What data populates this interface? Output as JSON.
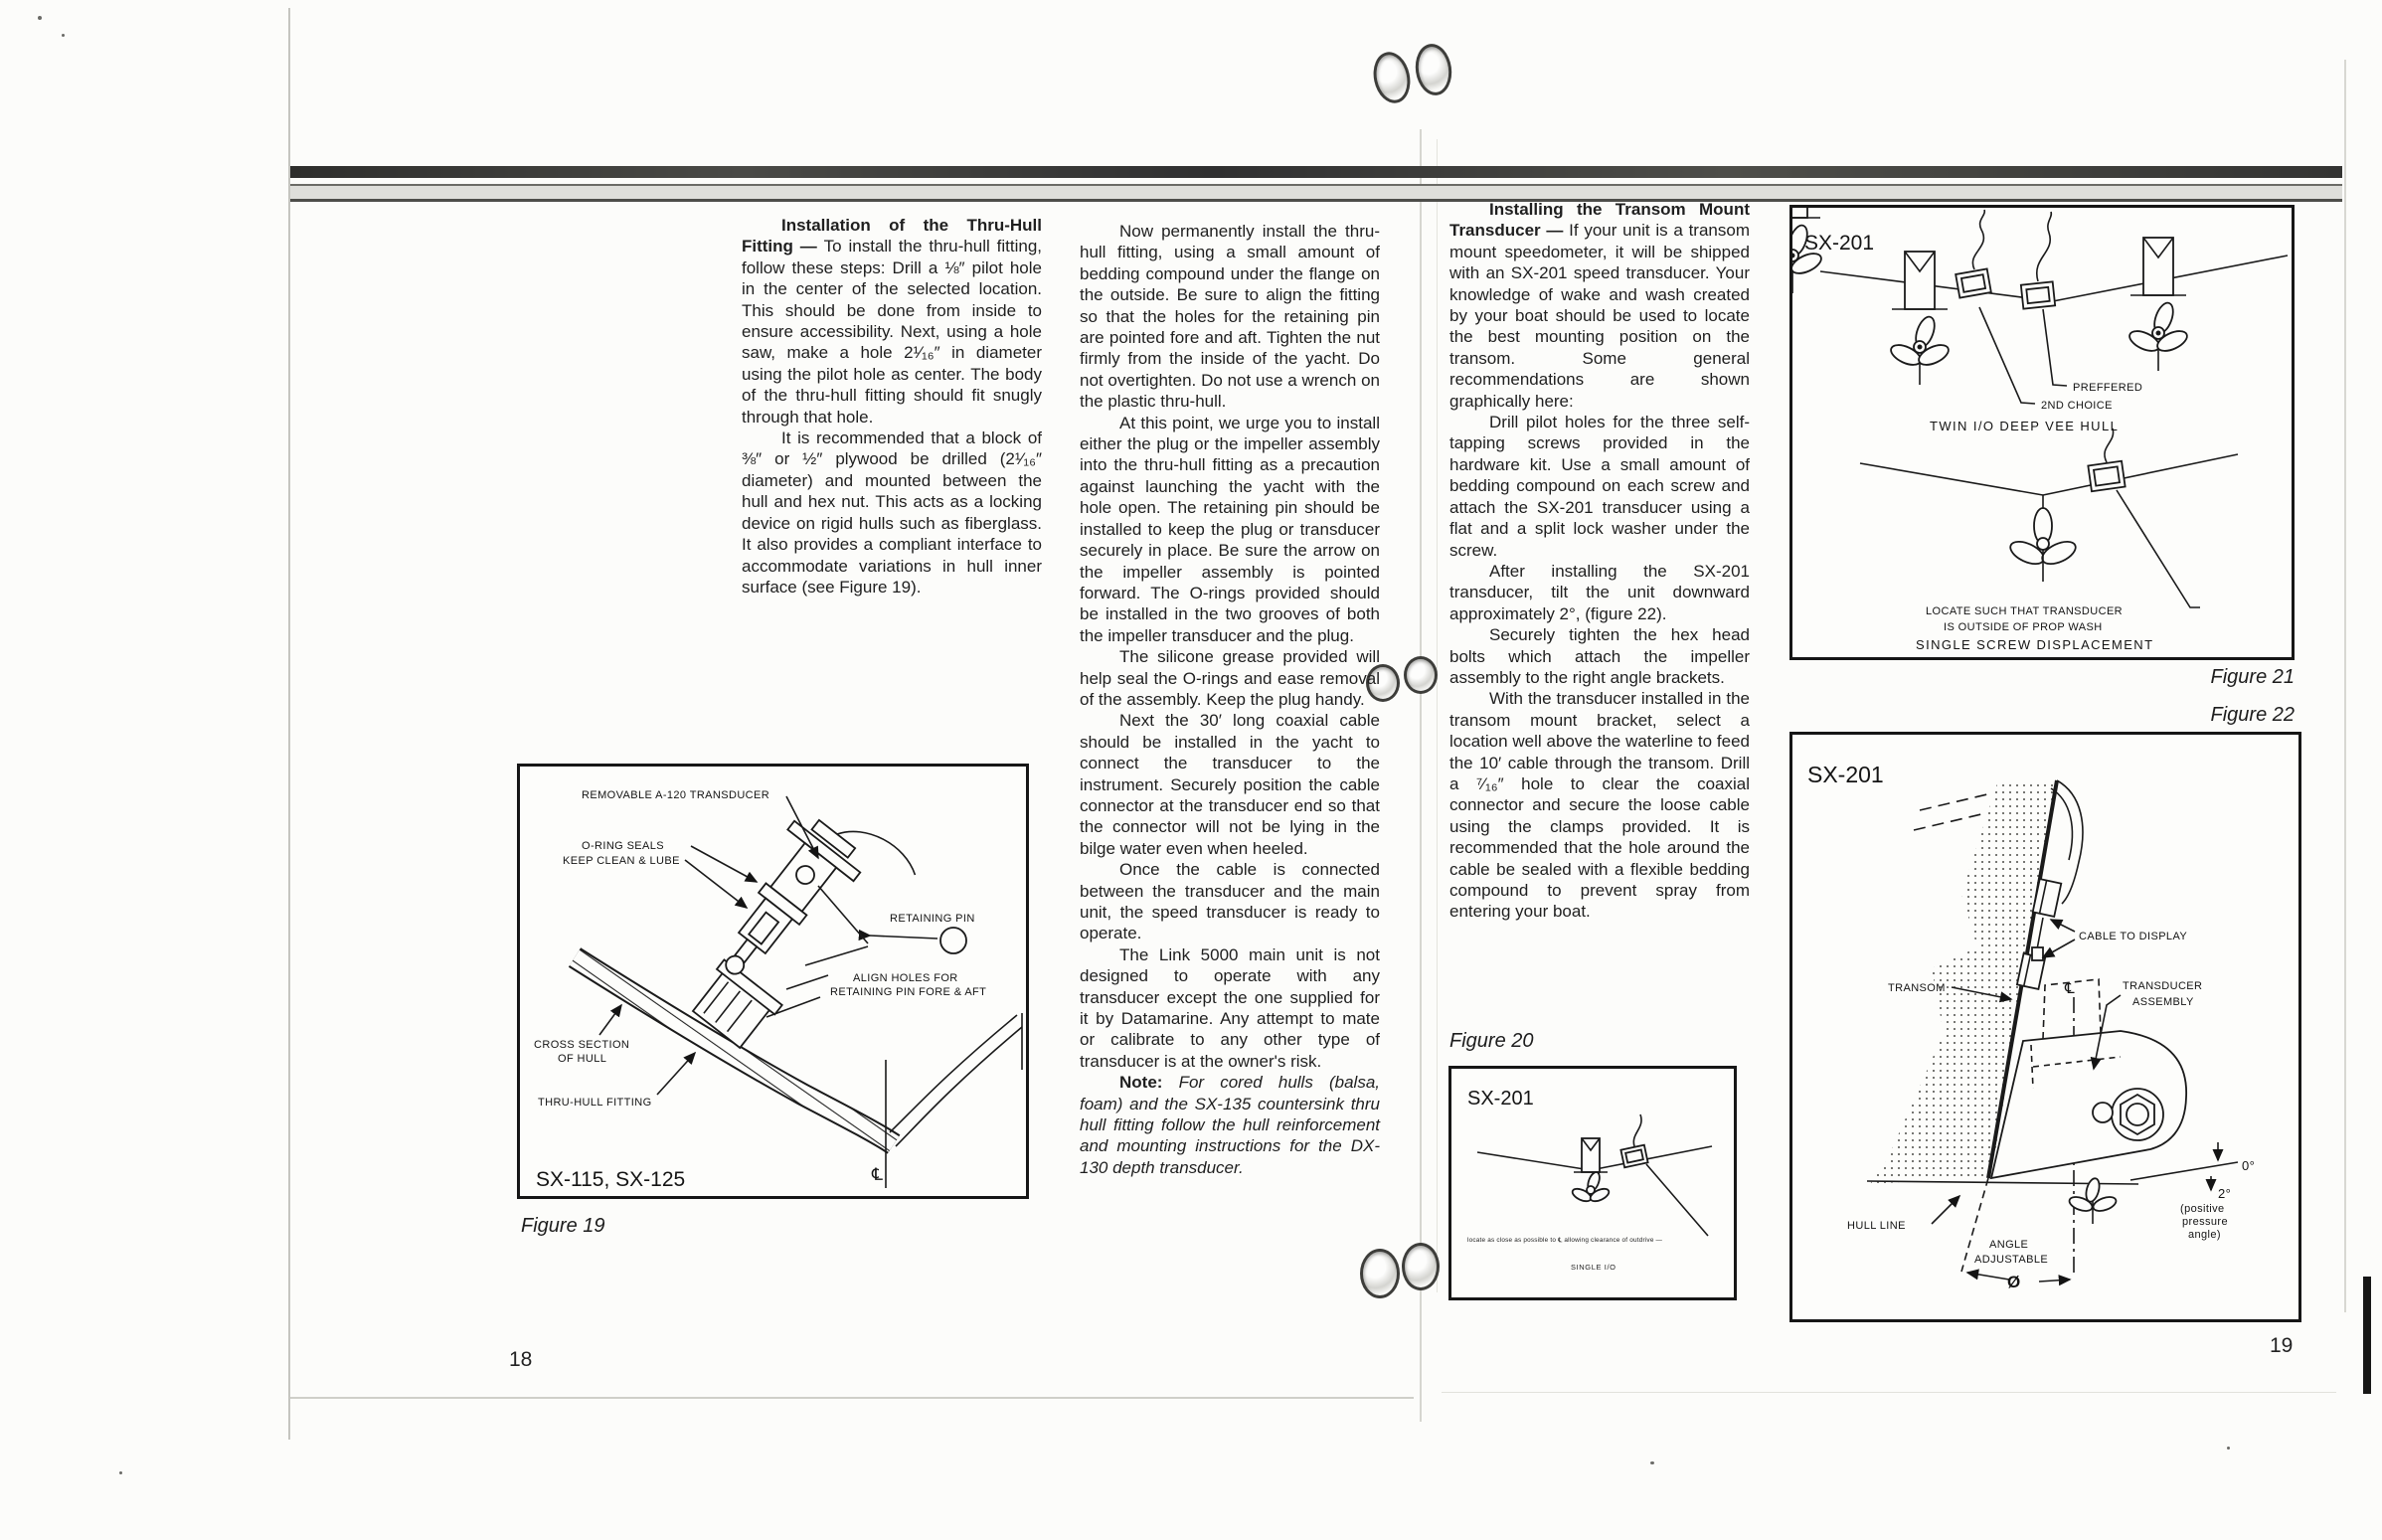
{
  "page": {
    "left_number": "18",
    "right_number": "19"
  },
  "article": {
    "col1": {
      "heading": "Installation of the Thru-Hull Fitting — ",
      "p1": "To install the thru-hull fitting, follow these steps: Drill a ⅛″ pilot hole in the center of the selected location. This should be done from inside to ensure accessibility. Next, using a hole saw, make a hole 2¹⁄₁₆″ in diameter using the pilot hole as center. The body of the thru-hull fitting should fit snugly through that hole.",
      "p2": "It is recommended that a block of ⅜″ or ½″ plywood be drilled (2¹⁄₁₆″ diameter) and mounted between the hull and hex nut. This acts as a locking device on rigid hulls such as fiberglass. It also provides a compliant interface to accommodate variations in hull inner surface (see Figure 19)."
    },
    "col2": {
      "p1": "Now permanently install the thru-hull fitting, using a small amount of bedding compound under the flange on the outside. Be sure to align the fitting so that the holes for the retaining pin are pointed fore and aft. Tighten the nut firmly from the inside of the yacht. Do not overtighten. Do not use a wrench on the plastic thru-hull.",
      "p2": "At this point, we urge you to install either the plug or the impeller assembly into the thru-hull fitting as a precaution against launching the yacht with the hole open. The retaining pin should be installed to keep the plug or transducer securely in place. Be sure the arrow on the impeller assembly is pointed forward. The O-rings provided should be installed in the two grooves of both the impeller transducer and the plug.",
      "p3": "The silicone grease provided will help seal the O-rings and ease removal of the assembly. Keep the plug handy.",
      "p4": "Next the 30′ long coaxial cable should be installed in the yacht to connect the transducer to the instrument. Securely position the cable connector at the transducer end so that the connector will not be lying in the bilge water even when heeled.",
      "p5": "Once the cable is connected between the transducer and the main unit, the speed transducer is ready to operate.",
      "p6": "The Link 5000 main unit is not designed to operate with any transducer except the one supplied for it by Datamarine. Any attempt to mate or calibrate to any other type of transducer is at the owner's risk.",
      "note_label": "Note: ",
      "note": "For cored hulls (balsa, foam) and the SX-135 countersink thru hull fitting follow the hull reinforcement and mounting instructions for the DX-130 depth transducer."
    },
    "col3": {
      "heading": "Installing the Transom Mount Transducer — ",
      "p1": "If your unit is a transom mount speedometer, it will be shipped with an SX-201 speed transducer. Your knowledge of wake and wash created by your boat should be used to locate the best mounting position on the transom. Some general recommendations are shown graphically here:",
      "p2": "Drill pilot holes for the three self-tapping screws provided in the hardware kit. Use a small amount of bedding compound on each screw and attach the SX-201 transducer using a flat and a split lock washer under the screw.",
      "p3": "After installing the SX-201 transducer, tilt the unit downward approximately 2°, (figure 22).",
      "p4": "Securely tighten the hex head bolts which attach the impeller assembly to the right angle brackets.",
      "p5": "With the transducer installed in the transom mount bracket, select a location well above the waterline to feed the 10′ cable through the transom. Drill a ⁷⁄₁₆″ hole to clear the coaxial connector and secure the loose cable using the clamps provided. It is recommended that the hole around the cable be sealed with a flexible bedding compound to prevent spray from entering your boat."
    }
  },
  "fig19": {
    "caption": "Figure 19",
    "model": "SX-115, SX-125",
    "label_removable": "REMOVABLE A-120 TRANSDUCER",
    "label_oring1": "O-RING SEALS",
    "label_oring2": "KEEP CLEAN & LUBE",
    "label_pin": "RETAINING PIN",
    "label_align1": "ALIGN HOLES FOR",
    "label_align2": "RETAINING PIN FORE & AFT",
    "label_cross1": "CROSS SECTION",
    "label_cross2": "OF HULL",
    "label_thruhull": "THRU-HULL FITTING",
    "label_cl": "℄"
  },
  "fig20": {
    "caption": "Figure 20",
    "model": "SX-201",
    "note": "locate as close as possible to ℄ allowing clearance of outdrive —",
    "sub": "SINGLE I/O"
  },
  "fig21": {
    "caption": "Figure 21",
    "model": "SX-201",
    "label_preferred": "PREFFERED",
    "label_choice": "2ND CHOICE",
    "label_twin": "TWIN I/O DEEP VEE HULL",
    "label_locate1": "LOCATE SUCH THAT TRANSDUCER",
    "label_locate2": "IS OUTSIDE OF PROP WASH",
    "label_single": "SINGLE SCREW DISPLACEMENT"
  },
  "fig22": {
    "caption": "Figure 22",
    "model": "SX-201",
    "label_cable": "CABLE TO DISPLAY",
    "label_transom": "TRANSOM",
    "label_assy1": "TRANSDUCER",
    "label_assy2": "ASSEMBLY",
    "label_hull": "HULL LINE",
    "label_angle1": "ANGLE",
    "label_angle2": "ADJUSTABLE",
    "label_phi": "Ø",
    "label_zero": "0°",
    "label_two": "2°",
    "label_pos1": "(positive",
    "label_pos2": "pressure",
    "label_pos3": "angle)",
    "label_cl": "℄"
  }
}
